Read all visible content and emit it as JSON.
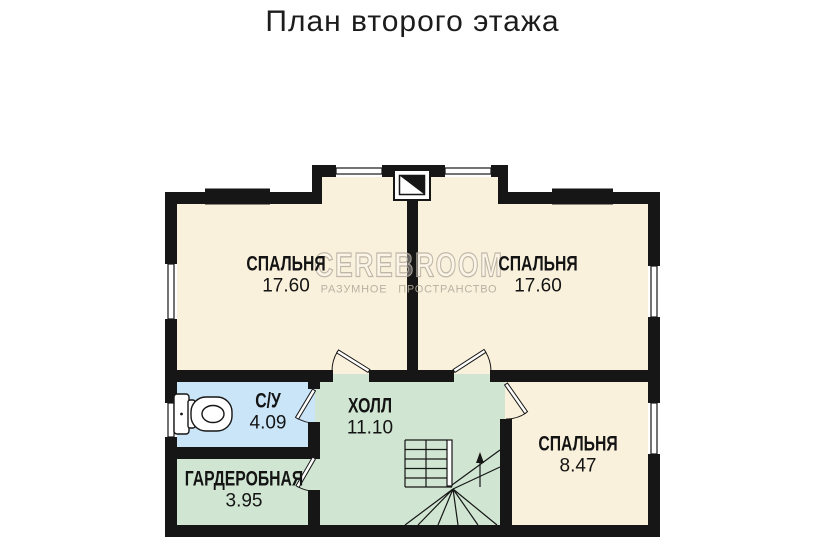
{
  "title": "План второго этажа",
  "watermark": {
    "brand": "CEREBROOM",
    "tagline": "РАЗУМНОЕ ПРОСТРАНСТВО"
  },
  "rooms": [
    {
      "id": "bedroom-top-left",
      "name": "СПАЛЬНЯ",
      "area": "17.60"
    },
    {
      "id": "bedroom-top-right",
      "name": "СПАЛЬНЯ",
      "area": "17.60"
    },
    {
      "id": "bathroom",
      "name": "С/У",
      "area": "4.09"
    },
    {
      "id": "hall",
      "name": "ХОЛЛ",
      "area": "11.10"
    },
    {
      "id": "wardrobe",
      "name": "ГАРДЕРОБНАЯ",
      "area": "3.95"
    },
    {
      "id": "bedroom-bottom-right",
      "name": "СПАЛЬНЯ",
      "area": "8.47"
    }
  ],
  "colors": {
    "room_cream": "#faf1dc",
    "bathroom_blue": "#cbe5f8",
    "hall_green": "#d0e6d2",
    "wall": "#161616"
  }
}
